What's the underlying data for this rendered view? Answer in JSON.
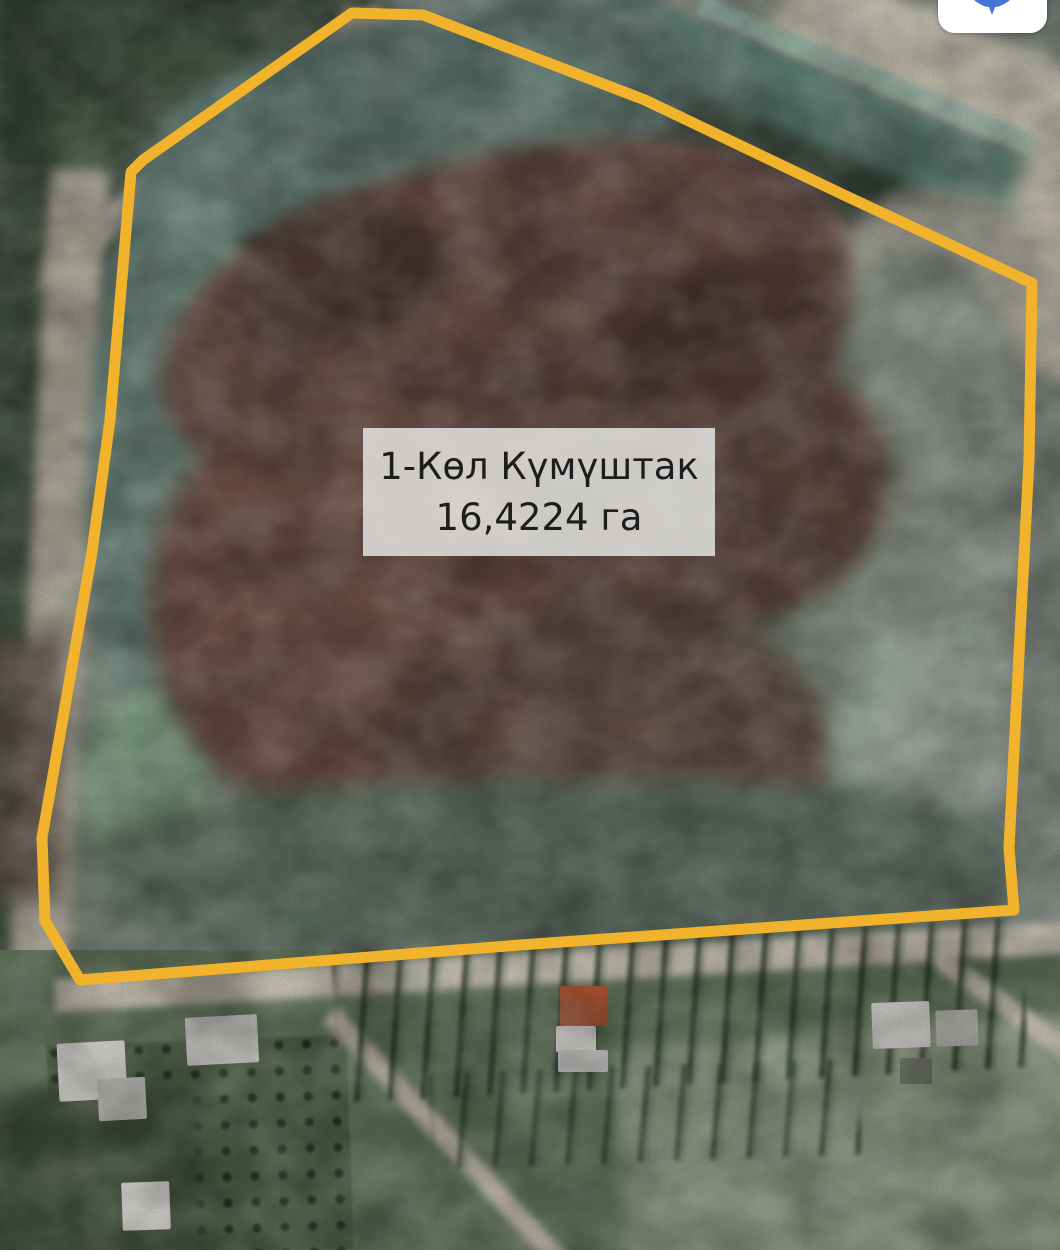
{
  "parcel": {
    "name": "1-Көл Күмүштак",
    "area": "16,4224 га",
    "outline_color": "#F2B32C",
    "outline_points": [
      [
        352,
        13
      ],
      [
        423,
        15
      ],
      [
        645,
        100
      ],
      [
        846,
        196
      ],
      [
        1032,
        283
      ],
      [
        1029,
        460
      ],
      [
        1009,
        848
      ],
      [
        1014,
        910
      ],
      [
        520,
        945
      ],
      [
        80,
        980
      ],
      [
        45,
        921
      ],
      [
        42,
        838
      ],
      [
        92,
        552
      ],
      [
        110,
        420
      ],
      [
        131,
        172
      ],
      [
        143,
        160
      ]
    ]
  },
  "controls": {
    "navigation_button": {
      "icon": "navigation-icon",
      "color": "#4573D5"
    }
  }
}
